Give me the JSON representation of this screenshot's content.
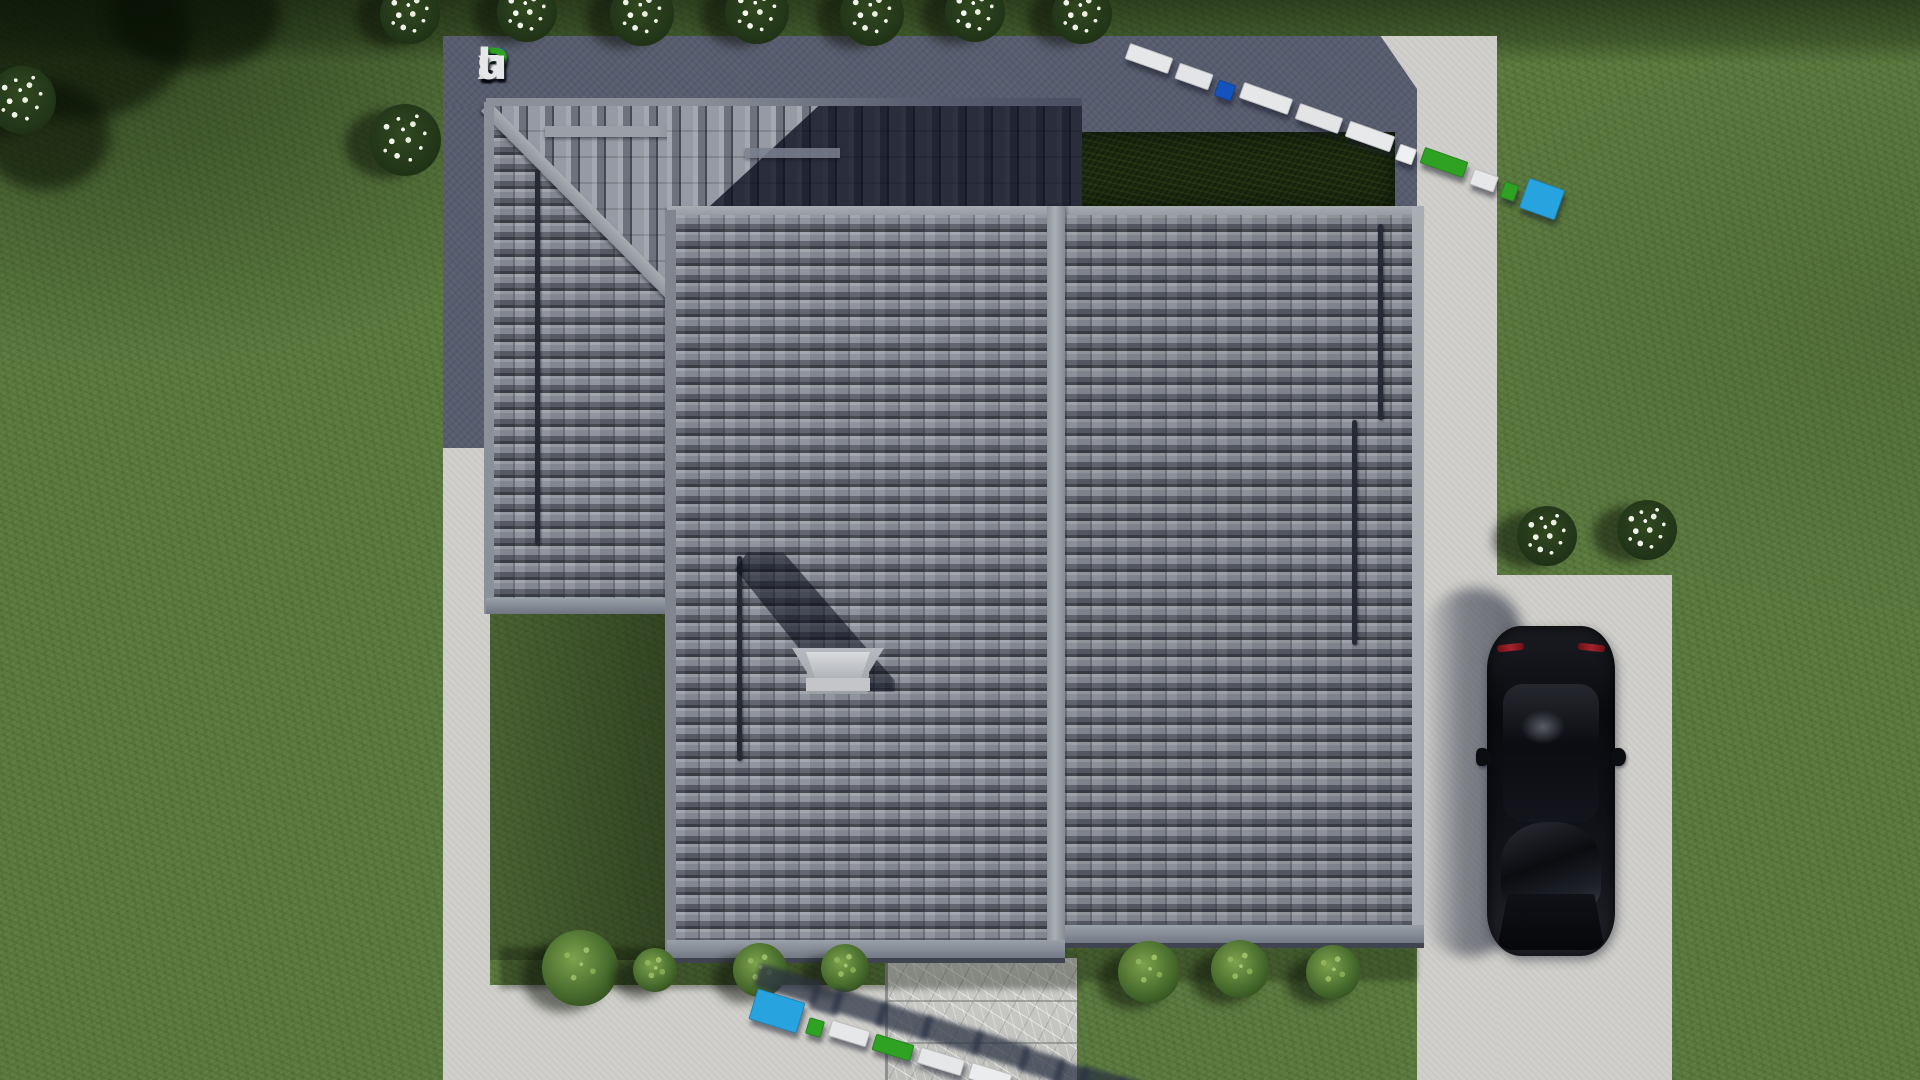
{
  "watermark": {
    "text": "FixPlans.ru",
    "letters": [
      {
        "ch": "F",
        "color": "#2057d8"
      },
      {
        "ch": "i",
        "color": "#2fa223"
      },
      {
        "ch": "x",
        "color": "#dfe0e3"
      },
      {
        "ch": "P",
        "color": "#2fa223"
      },
      {
        "ch": "l",
        "color": "#e6e7e9"
      },
      {
        "ch": "a",
        "color": "#e6e7e9"
      },
      {
        "ch": "n",
        "color": "#e6e7e9"
      },
      {
        "ch": "s",
        "color": "#e6e7e9"
      },
      {
        "ch": ".",
        "color": "#2057d8"
      },
      {
        "ch": "r",
        "color": "#e6e7e9"
      },
      {
        "ch": "u",
        "color": "#e6e7e9"
      }
    ]
  },
  "watermark_3d": {
    "top_blocks": [
      {
        "color": "#e6e7e9",
        "w": 46
      },
      {
        "color": "#e3e4e7",
        "w": 36
      },
      {
        "color": "#1453bd",
        "w": 18
      },
      {
        "color": "#e6e7e9",
        "w": 52
      },
      {
        "color": "#e3e4e6",
        "w": 46
      },
      {
        "color": "#e8e9eb",
        "w": 48
      },
      {
        "color": "#eff0f1",
        "w": 18
      },
      {
        "color": "#2fa223",
        "w": 46
      },
      {
        "color": "#e6e7e9",
        "w": 26
      },
      {
        "color": "#2fa223",
        "w": 15
      },
      {
        "color": "#27a3df",
        "w": 38,
        "h": 32
      }
    ],
    "bottom_blocks": [
      {
        "color": "#27a3df",
        "w": 50,
        "h": 32
      },
      {
        "color": "#2fa223",
        "w": 16
      },
      {
        "color": "#e6e7e9",
        "w": 40
      },
      {
        "color": "#2fa223",
        "w": 40
      },
      {
        "color": "#e6e7e9",
        "w": 46
      },
      {
        "color": "#ebecee",
        "w": 42
      },
      {
        "color": "#e6e7e9",
        "w": 30
      },
      {
        "color": "#1453bd",
        "w": 18
      },
      {
        "color": "#e6e7e9",
        "w": 30
      },
      {
        "color": "#eff0f1",
        "w": 36
      }
    ]
  },
  "palette": {
    "grass": "#5b7a3e",
    "pad": "#575c6e",
    "conc": "#d0cfcb",
    "tile": "#8a8e99",
    "ridge": "#9aa0a8",
    "hedge": "#1c2a10",
    "marble": "#c9cac6",
    "car": "#0b0c10",
    "logo_blue": "#2057d8",
    "logo_green": "#2fa223",
    "logo_white": "#e6e7e9",
    "cyan": "#27a3df"
  }
}
